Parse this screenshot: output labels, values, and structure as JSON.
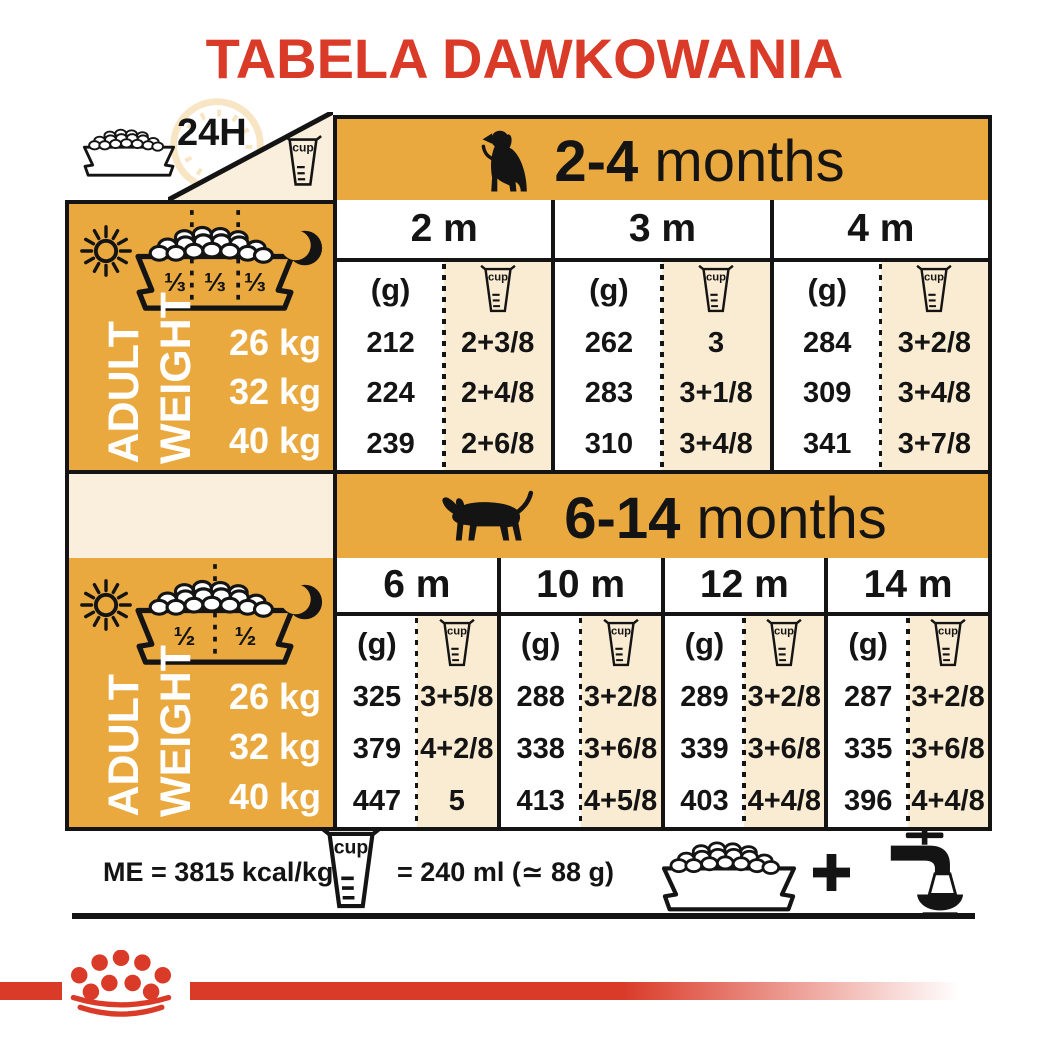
{
  "title": "TABELA DAWKOWANIA",
  "h24": "24H",
  "cup_label": "cup",
  "unit_g": "(g)",
  "adult_weight": {
    "line1": "ADULT",
    "line2": "WEIGHT"
  },
  "weights": [
    "26 kg",
    "32 kg",
    "40 kg"
  ],
  "section1": {
    "age": "2-4",
    "age_unit": "months",
    "portions": [
      "⅓",
      "⅓",
      "⅓"
    ],
    "months": [
      {
        "label": "2 m",
        "g": [
          "212",
          "224",
          "239"
        ],
        "cups": [
          "2+3/8",
          "2+4/8",
          "2+6/8"
        ]
      },
      {
        "label": "3 m",
        "g": [
          "262",
          "283",
          "310"
        ],
        "cups": [
          "3",
          "3+1/8",
          "3+4/8"
        ]
      },
      {
        "label": "4 m",
        "g": [
          "284",
          "309",
          "341"
        ],
        "cups": [
          "3+2/8",
          "3+4/8",
          "3+7/8"
        ]
      }
    ]
  },
  "section2": {
    "age": "6-14",
    "age_unit": "months",
    "portions": [
      "½",
      "½"
    ],
    "months": [
      {
        "label": "6 m",
        "g": [
          "325",
          "379",
          "447"
        ],
        "cups": [
          "3+5/8",
          "4+2/8",
          "5"
        ]
      },
      {
        "label": "10 m",
        "g": [
          "288",
          "338",
          "413"
        ],
        "cups": [
          "3+2/8",
          "3+6/8",
          "4+5/8"
        ]
      },
      {
        "label": "12 m",
        "g": [
          "289",
          "339",
          "403"
        ],
        "cups": [
          "3+2/8",
          "3+6/8",
          "4+4/8"
        ]
      },
      {
        "label": "14 m",
        "g": [
          "287",
          "335",
          "396"
        ],
        "cups": [
          "3+2/8",
          "3+6/8",
          "4+4/8"
        ]
      }
    ]
  },
  "footer": {
    "me": "ME = 3815 kcal/kg",
    "cup_equiv": "= 240 ml (≃ 88 g)"
  },
  "colors": {
    "red": "#DA3A28",
    "gold": "#EAA93E",
    "cream": "#FAECD2",
    "panel_cream": "#FAEFDC",
    "pale_gold": "#F8E5C4",
    "ink": "#141414"
  }
}
